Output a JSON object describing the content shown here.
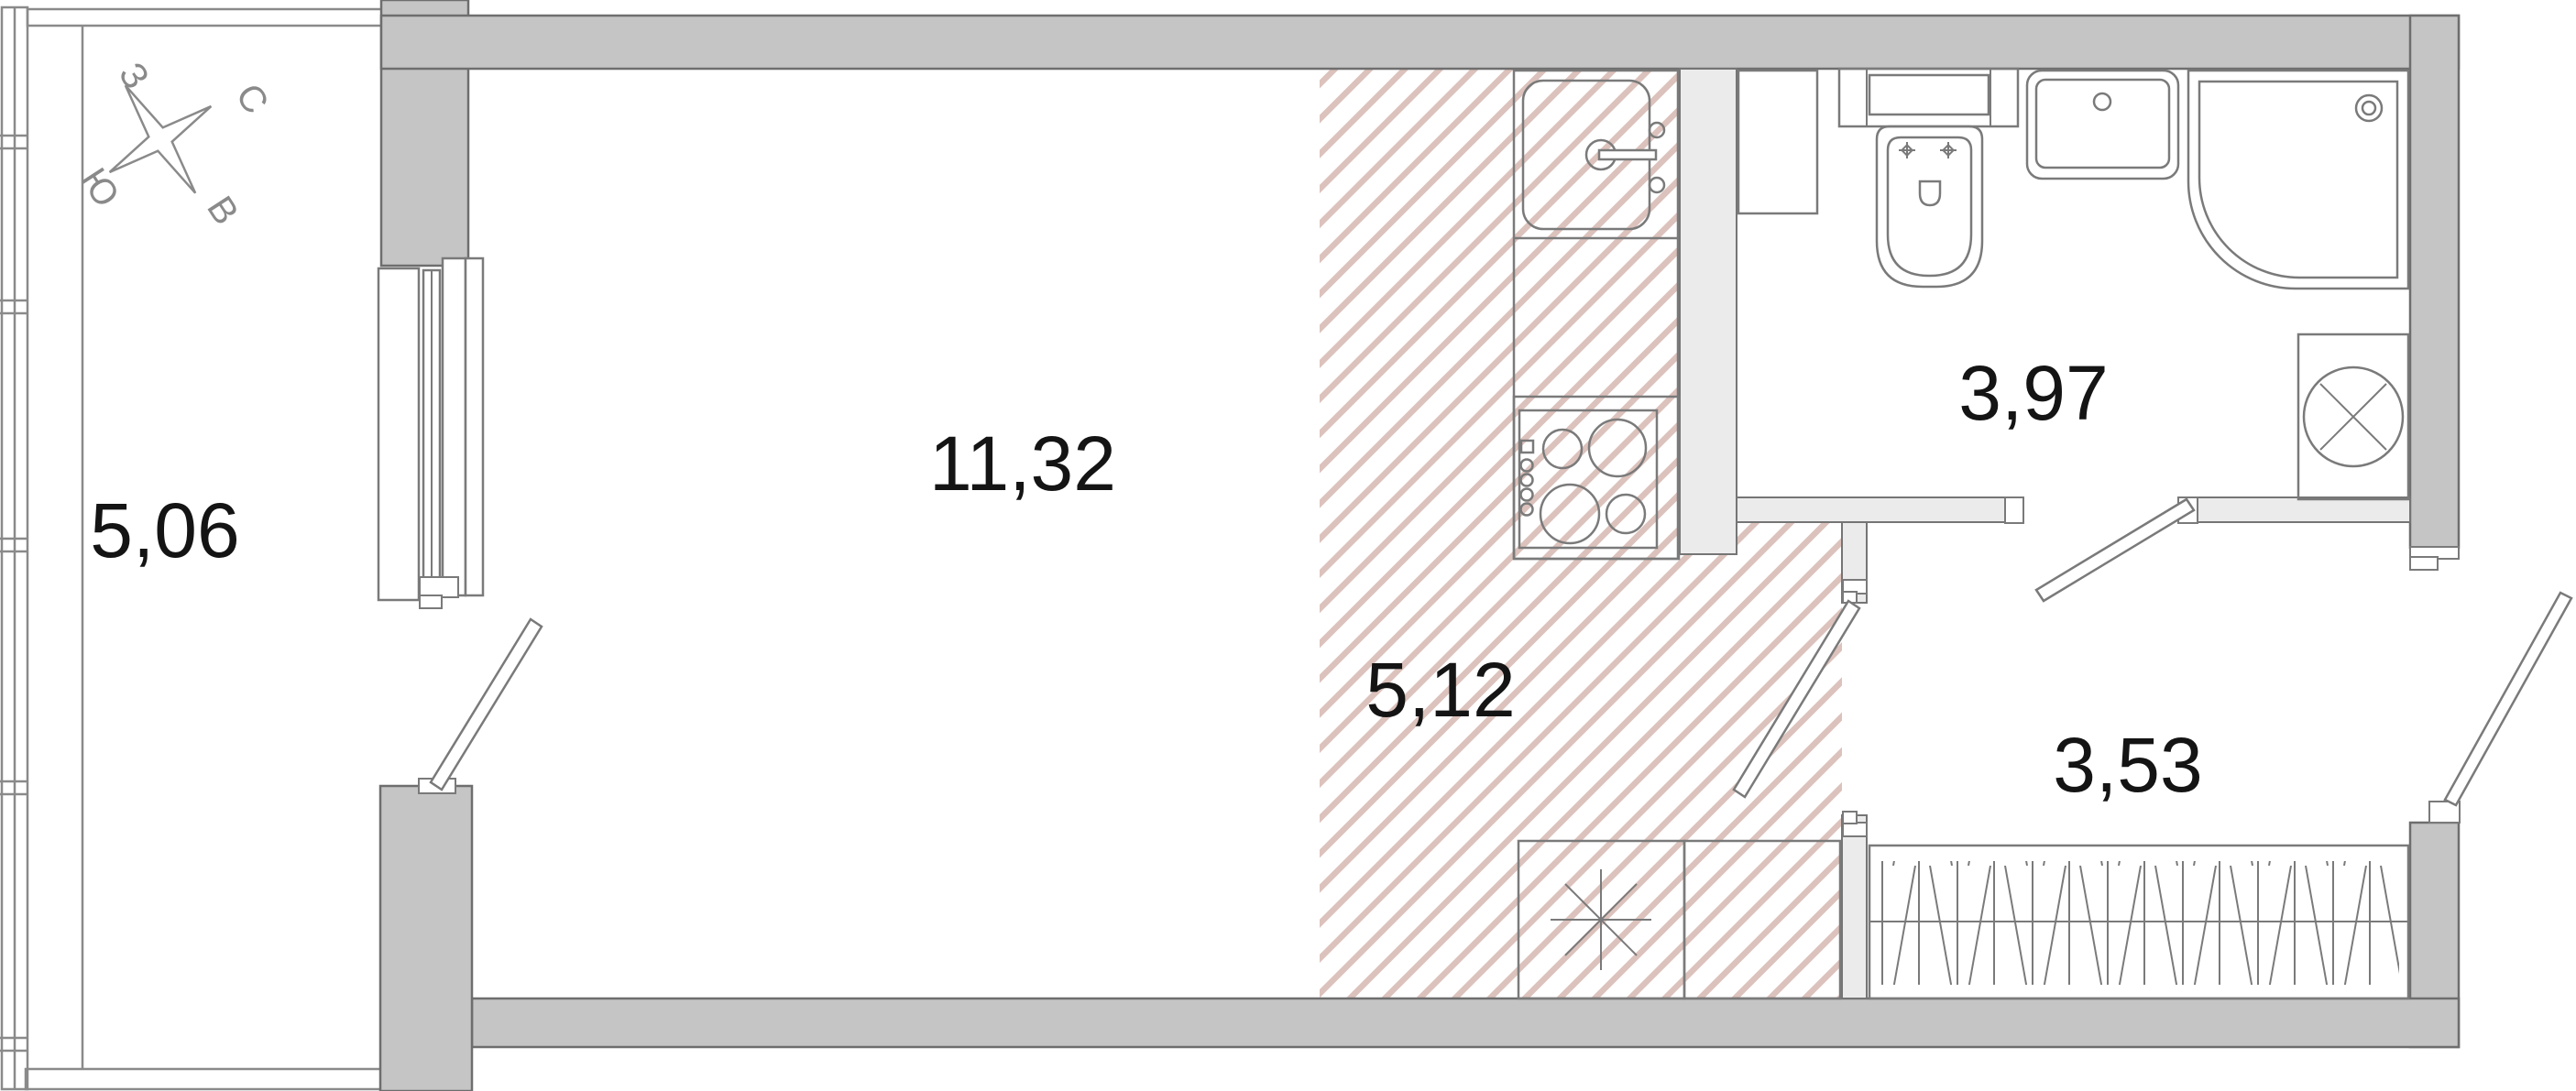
{
  "plan": {
    "type": "apartment-floor-plan",
    "compass": {
      "west": "З",
      "north": "С",
      "south": "Ю",
      "east": "В"
    },
    "rooms": [
      {
        "name": "balcony",
        "area_label": "5,06"
      },
      {
        "name": "living-room",
        "area_label": "11,32"
      },
      {
        "name": "kitchen",
        "area_label": "5,12"
      },
      {
        "name": "bathroom",
        "area_label": "3,97"
      },
      {
        "name": "hallway",
        "area_label": "3,53"
      }
    ],
    "fixtures": [
      "kitchen-sink",
      "stove",
      "kitchen-cabinets",
      "toilet",
      "washbasin",
      "shower",
      "washing-machine",
      "wardrobe"
    ],
    "colors": {
      "exterior_wall": "#c5c5c5",
      "interior_wall": "#ebebeb",
      "wall_outline": "#6e6e6e",
      "fixture_outline": "#7a7a7a",
      "kitchen_hatch": "#dcc2bc",
      "label_text": "#141414"
    }
  }
}
